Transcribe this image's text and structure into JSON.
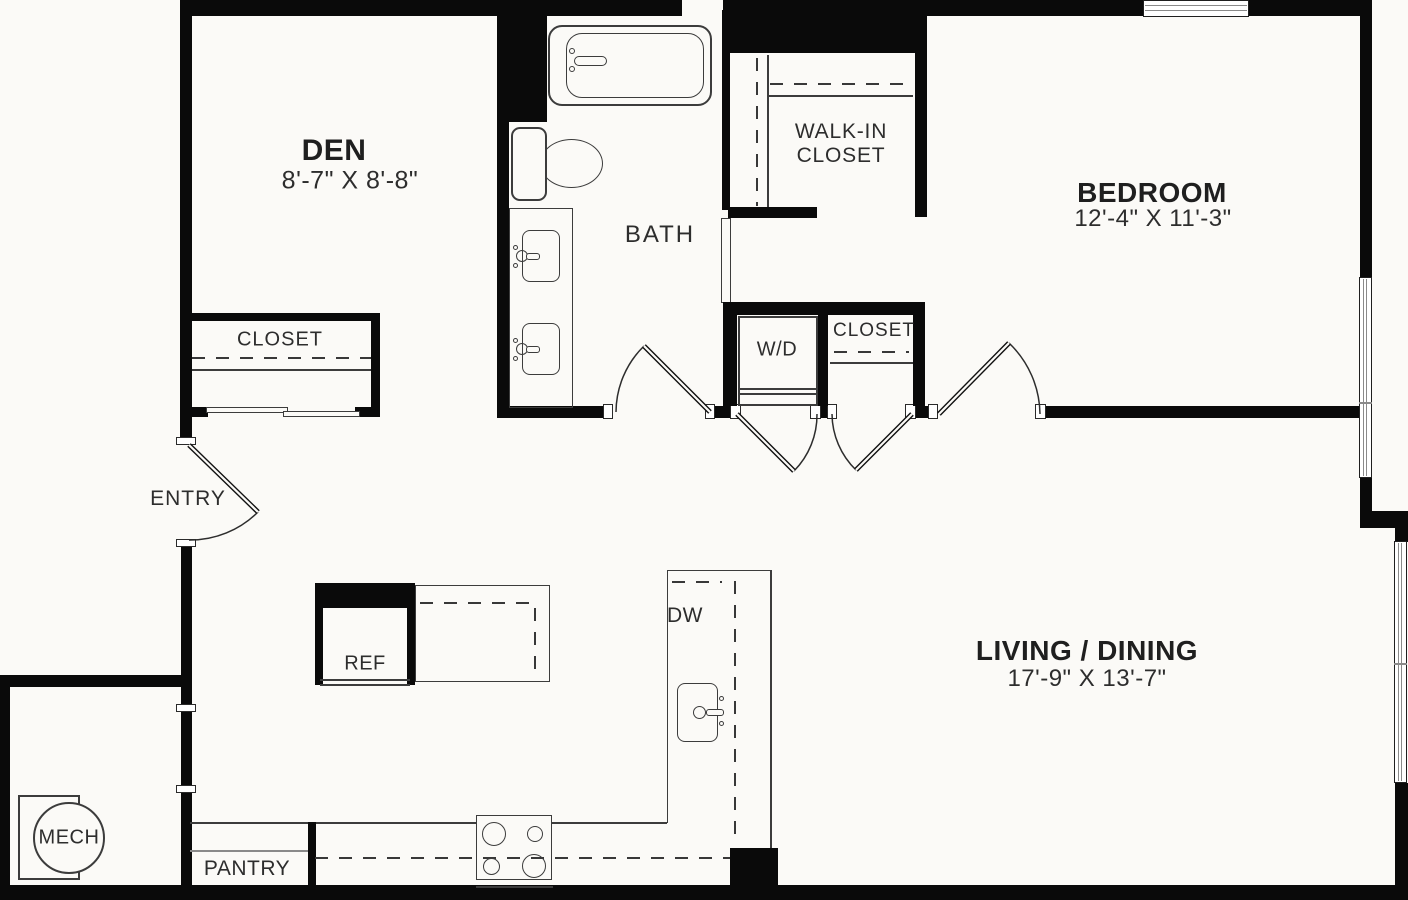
{
  "plan_title": "One-bedroom with den floor plan",
  "rooms": {
    "den": {
      "name": "DEN",
      "dims": "8'-7\" X 8'-8\""
    },
    "den_closet": {
      "name": "CLOSET"
    },
    "bath": {
      "name": "BATH"
    },
    "walk_in_closet": {
      "name": "WALK-IN CLOSET"
    },
    "bedroom": {
      "name": "BEDROOM",
      "dims": "12'-4\" X 11'-3\""
    },
    "laundry": {
      "name": "W/D"
    },
    "bedroom_closet": {
      "name": "CLOSET"
    },
    "entry": {
      "name": "ENTRY"
    },
    "living": {
      "name": "LIVING / DINING",
      "dims": "17'-9\" X 13'-7\""
    },
    "mech": {
      "name": "MECH"
    },
    "pantry": {
      "name": "PANTRY"
    },
    "kitchen": {
      "refrigerator": "REF",
      "dishwasher": "DW"
    }
  },
  "colors": {
    "wall": "#0a0a0a",
    "fixture_line": "#3c3c3c",
    "floor": "#fbfaf7",
    "text": "#2d2d2d"
  }
}
